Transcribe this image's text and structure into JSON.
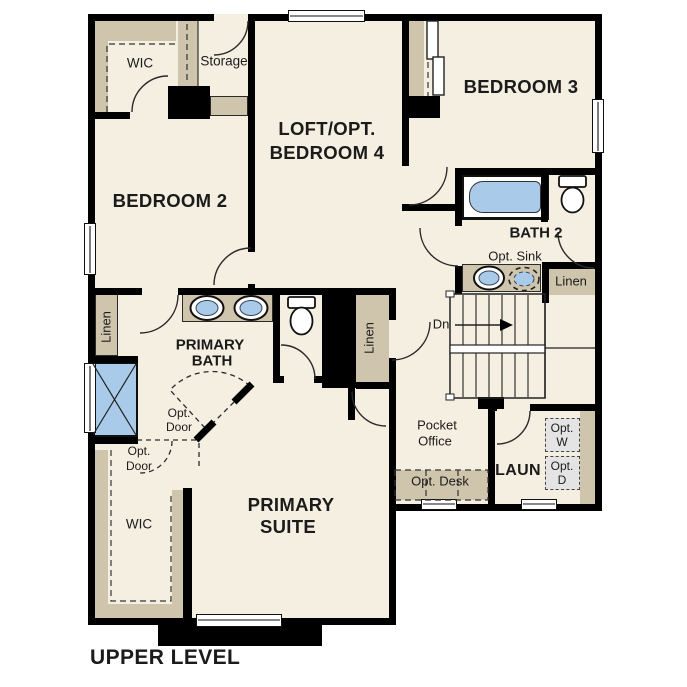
{
  "title": "UPPER LEVEL",
  "colors": {
    "wall": "#000000",
    "floor": "#f5efe2",
    "cabinetry_tan": "#cfc5ad",
    "fixture_blue": "#a9cbe9",
    "optional_appliance_gray": "#e4e4e4",
    "background": "#ffffff"
  },
  "rooms": {
    "wic_upper": {
      "name": "WIC"
    },
    "storage": {
      "name": "Storage"
    },
    "bedroom2": {
      "name": "BEDROOM 2"
    },
    "loft": {
      "name_line1": "LOFT/OPT.",
      "name_line2": "BEDROOM 4"
    },
    "bedroom3": {
      "name": "BEDROOM 3"
    },
    "bath2": {
      "name": "BATH 2"
    },
    "primary_bath": {
      "name_line1": "PRIMARY",
      "name_line2": "BATH"
    },
    "primary_suite": {
      "name_line1": "PRIMARY",
      "name_line2": "SUITE"
    },
    "wic_lower": {
      "name": "WIC"
    },
    "pocket_office": {
      "name_line1": "Pocket",
      "name_line2": "Office"
    },
    "laundry": {
      "name": "LAUN"
    }
  },
  "features": {
    "stairs": {
      "direction": "Dn"
    },
    "opt_sink": {
      "label": "Opt. Sink"
    },
    "opt_desk": {
      "label": "Opt. Desk"
    },
    "opt_washer": {
      "line1": "Opt.",
      "line2": "W"
    },
    "opt_dryer": {
      "line1": "Opt.",
      "line2": "D"
    },
    "linen_bath2": {
      "label": "Linen"
    },
    "linen_hall": {
      "label": "Linen"
    },
    "linen_primary_bath": {
      "label": "Linen"
    },
    "opt_door_bath": {
      "line1": "Opt.",
      "line2": "Door"
    },
    "opt_door_wic": {
      "line1": "Opt.",
      "line2": "Door"
    }
  }
}
